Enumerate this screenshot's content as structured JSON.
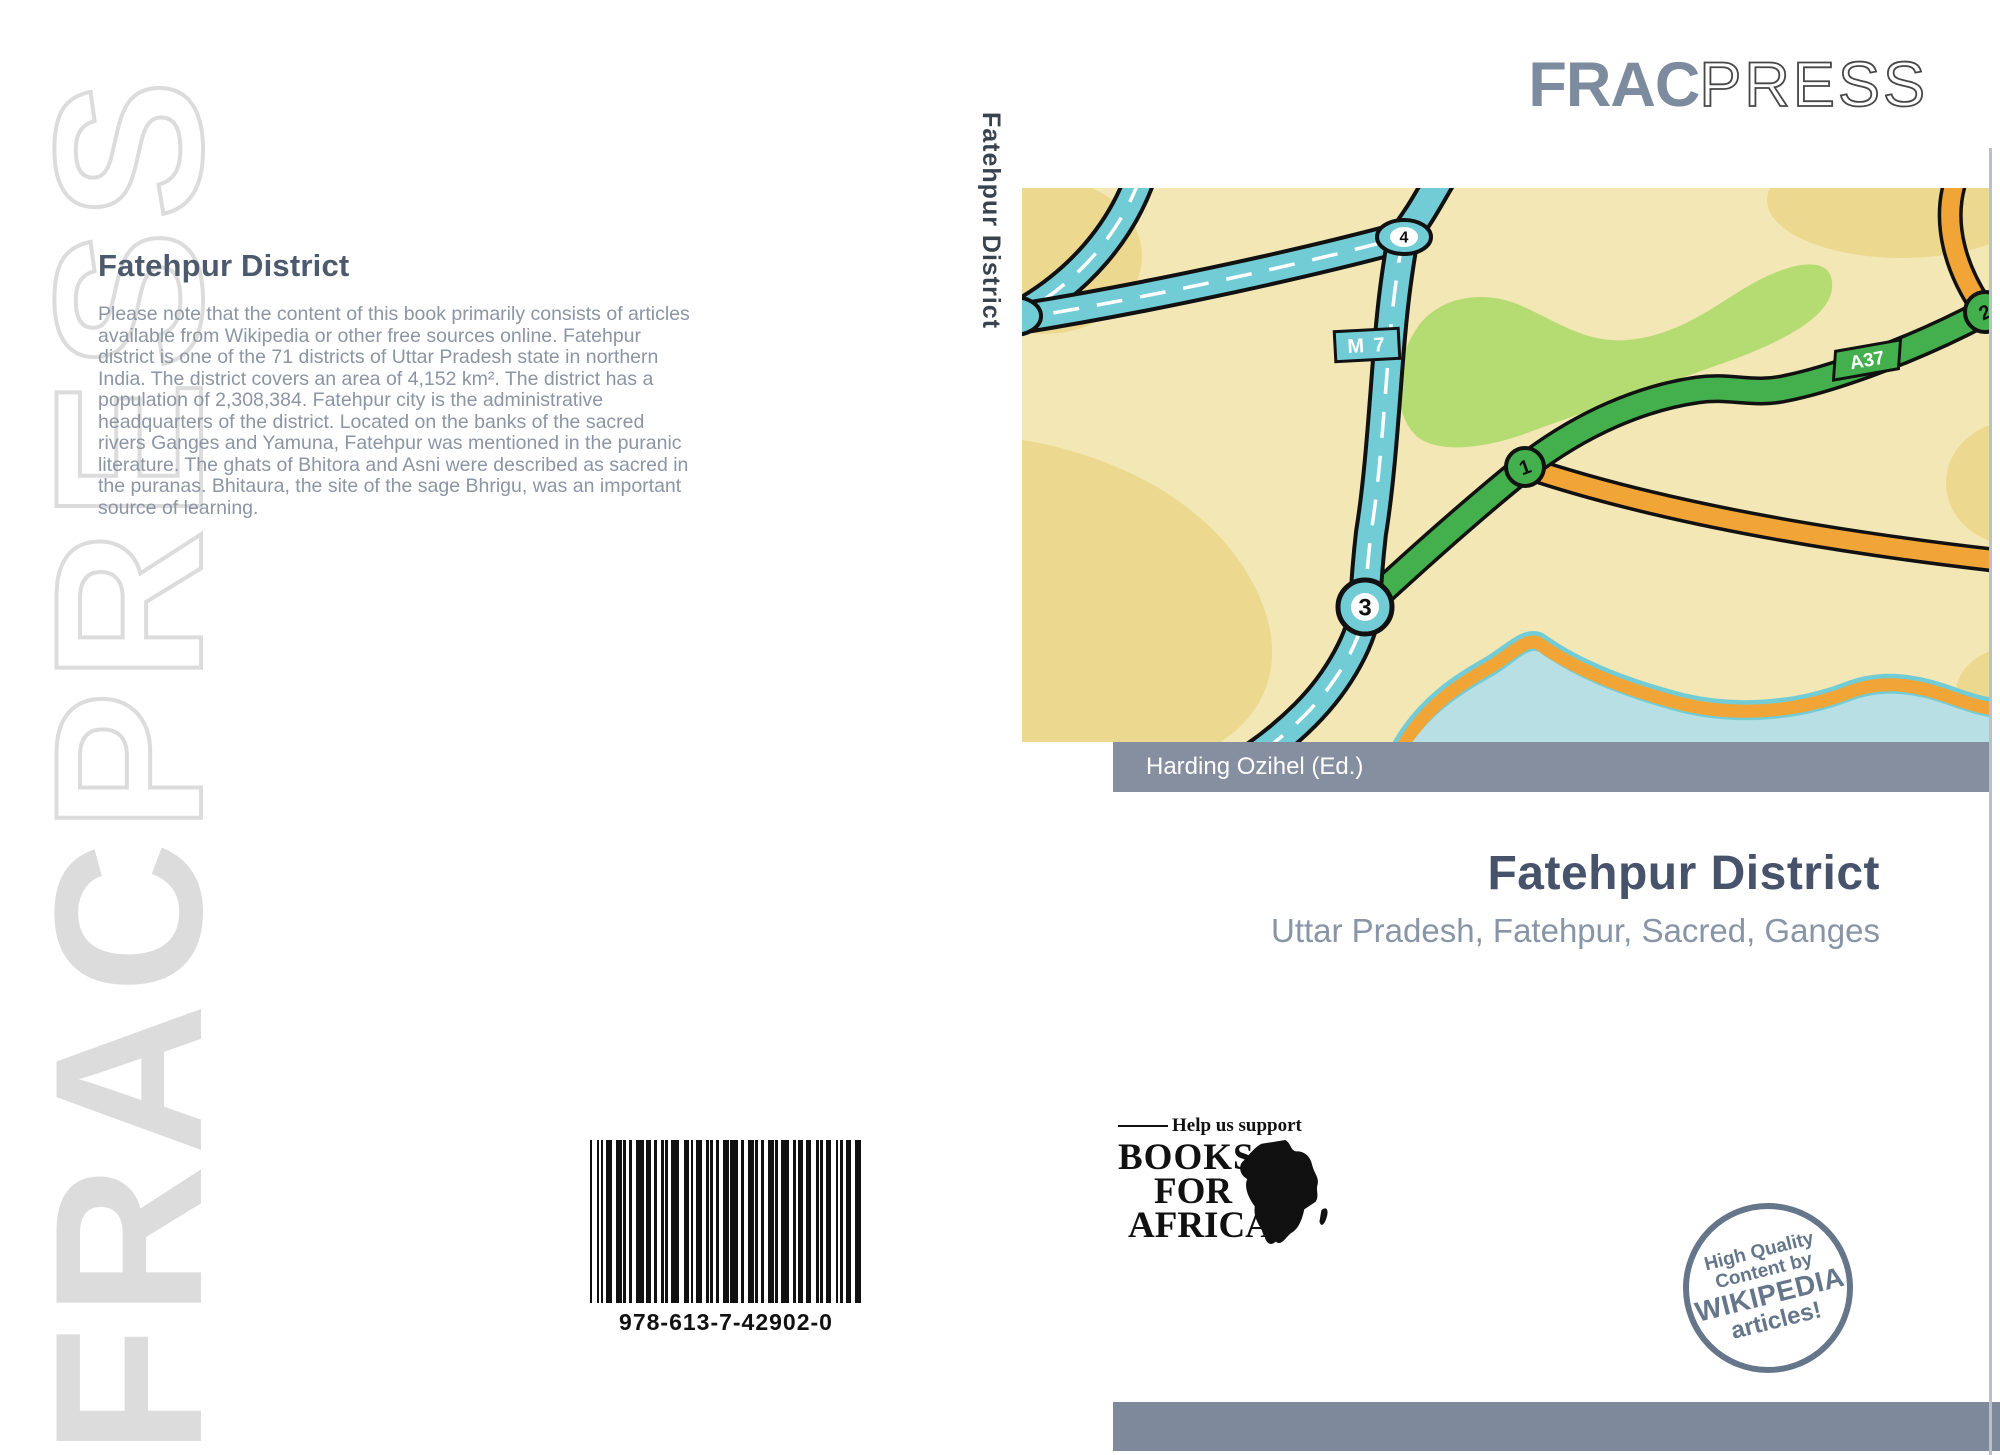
{
  "watermark": {
    "bold": "FRAC",
    "outline": "PRESS"
  },
  "back_cover": {
    "title": "Fatehpur District",
    "description": "Please note that the content of this book primarily consists of articles available from Wikipedia or other free sources online. Fatehpur district is one of the 71 districts of Uttar Pradesh state in northern India. The district covers an area of 4,152 km². The district has a population of 2,308,384. Fatehpur city is the administrative headquarters of the district. Located on the banks of the sacred rivers Ganges and Yamuna, Fatehpur was mentioned in the puranic literature. The ghats of Bhitora and Asni were described as sacred in the puranas. Bhitaura, the site of the sage Bhrigu, was an important source of learning.",
    "isbn": "978-613-7-42902-0"
  },
  "spine": {
    "title": "Fatehpur District"
  },
  "front_cover": {
    "logo_bold": "FRAC",
    "logo_light": "PRESS",
    "editor": "Harding Ozihel (Ed.)",
    "title": "Fatehpur District",
    "subtitle": "Uttar Pradesh, Fatehpur, Sacred, Ganges",
    "map": {
      "m7": "M 7",
      "a37": "A37",
      "junction1": "1",
      "junction2": "2",
      "junction3": "3",
      "junction4": "4"
    },
    "bfa": {
      "tagline": "Help us support",
      "word1": "BOOKS",
      "word2": "FOR",
      "word3": "AFRICA"
    },
    "stamp": {
      "line1": "High Quality",
      "line2": "Content by",
      "line3": "WIKIPEDIA",
      "line4": "articles!"
    }
  },
  "colors": {
    "accent_slate": "#46536b",
    "muted_text": "#8b95a3",
    "logo_gray_blue": "#7c8b9d",
    "bar_gray": "#858fa0",
    "bottom_bar_gray": "#7e8a9b",
    "stamp_gray": "#65768a",
    "map_background": "#f2e7b5",
    "map_tan": "#ecd98f",
    "map_green_area": "#b5dc73",
    "road_teal": "#72ccd6",
    "road_green": "#43b04d",
    "road_orange": "#f2a537",
    "water_blue": "#b8dfe3"
  }
}
